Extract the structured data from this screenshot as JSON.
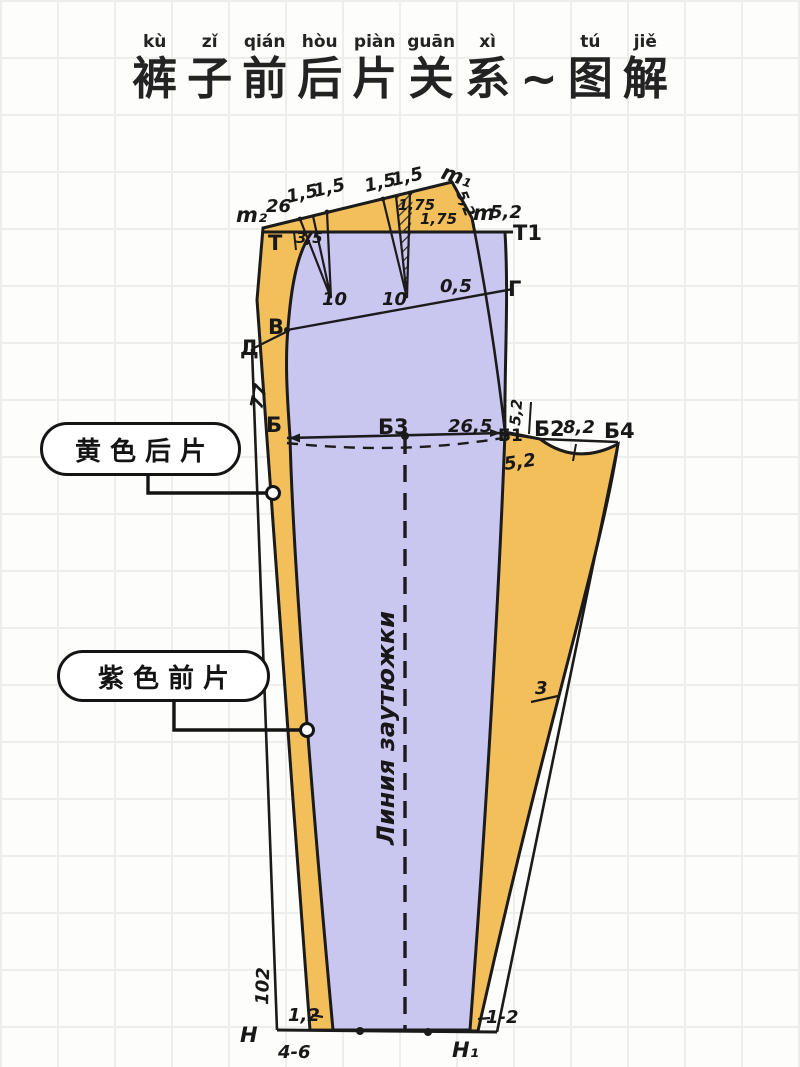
{
  "title": {
    "chars": [
      {
        "pinyin": "kù",
        "char": "裤"
      },
      {
        "pinyin": "zǐ",
        "char": "子"
      },
      {
        "pinyin": "qián",
        "char": "前"
      },
      {
        "pinyin": "hòu",
        "char": "后"
      },
      {
        "pinyin": "piàn",
        "char": "片"
      },
      {
        "pinyin": "guān",
        "char": "关"
      },
      {
        "pinyin": "xì",
        "char": "系"
      },
      {
        "pinyin": "",
        "char": "~"
      },
      {
        "pinyin": "tú",
        "char": "图"
      },
      {
        "pinyin": "jiě",
        "char": "解"
      }
    ]
  },
  "callouts": {
    "back_piece": "黄色后片",
    "front_piece": "紫色前片"
  },
  "colors": {
    "back_piece_yellow": "#f3bf5b",
    "front_piece_purple": "#c9c6f0",
    "outline": "#1b1b1b",
    "red_label": "#a23b2a"
  },
  "diagram": {
    "labels": {
      "m2": "m₂",
      "w26": "26",
      "fifteen_a": "1,5",
      "fifteen_b": "1,5",
      "fifteen_c": "1,5",
      "fifteen_d": "1,5",
      "m1": "m₁",
      "m1_52": "5,2",
      "m": "m",
      "m_52": "5,2",
      "T1": "Т1",
      "T": "Т",
      "w35": "3,5",
      "r175a": "1,75",
      "r175b": "1,75",
      "ten_a": "10",
      "ten_b": "10",
      "half": "0,5",
      "G": "Г",
      "V": "В",
      "D": "Д",
      "w77": "77",
      "B": "Б",
      "B3": "Б3",
      "w265": "26,5",
      "B1": "Б1",
      "B2": "Б2",
      "w82": "8,2",
      "B4": "Б4",
      "w52_up": "5,2",
      "w52_dn": "5,2",
      "three": "3",
      "crease_line": "Линия заутюжки",
      "w102": "102",
      "w12": "1,2",
      "N": "Н",
      "w46": "4-6",
      "N1": "Н₁",
      "w1_2": "1-2"
    }
  }
}
